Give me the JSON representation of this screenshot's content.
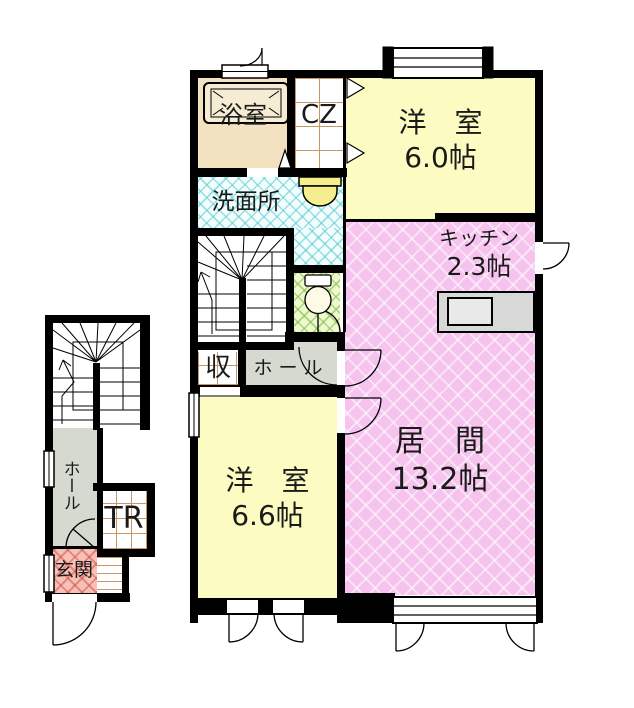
{
  "plan_title": "2F floor plan",
  "rooms": {
    "bathroom": {
      "label": "浴室"
    },
    "cz": {
      "label": "CZ"
    },
    "bedroom_a": {
      "label": "洋　室",
      "size": "6.0帖"
    },
    "washroom": {
      "label": "洗面所"
    },
    "kitchen": {
      "label": "キッチン",
      "size": "2.3帖"
    },
    "living": {
      "label": "居　間",
      "size": "13.2帖"
    },
    "storage": {
      "label": "収"
    },
    "hall_main": {
      "label": "ホール"
    },
    "bedroom_b": {
      "label": "洋　室",
      "size": "6.6帖"
    },
    "tr": {
      "label": "TR"
    },
    "hall_entry": {
      "label": "ホール"
    },
    "entry": {
      "label": "玄関"
    }
  },
  "colors": {
    "wall": "#000000",
    "bedroom_yellow": "#fcfcc2",
    "living_pink": "#f6c2ee",
    "washroom_cyan": "#48c8cd",
    "toilet_green": "#78be3c",
    "bath_beige": "#f2e2c0",
    "hall_gray": "#d5d9cf",
    "entry_pink": "#f8c0b7",
    "grid_tan": "#c79566",
    "counter_gray": "#d8d8d8",
    "basin_yellow": "#f5ee8e"
  }
}
